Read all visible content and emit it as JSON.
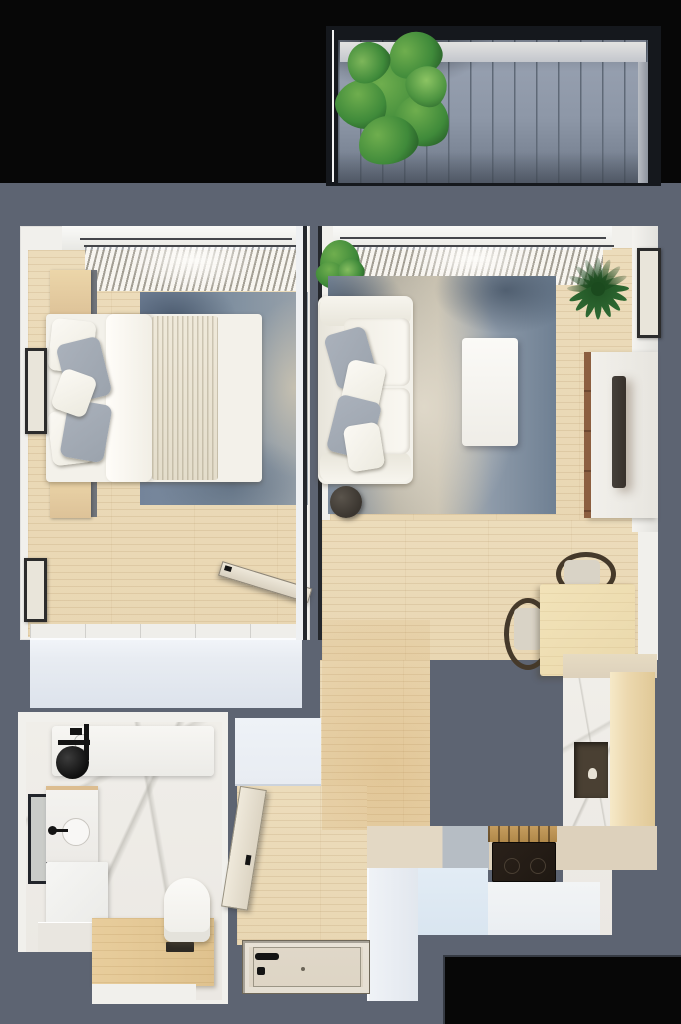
{
  "meta": {
    "title": "One-bedroom apartment floor plan, top-down 3D render",
    "image_type": "floor-plan",
    "view": "top-down"
  },
  "palette": {
    "outside": "#070707",
    "wall": "#5d6472",
    "room_wall_face": "#f1f0ec",
    "wood_floor": "#e9d7b3",
    "deck": "#8d97a7",
    "deck_line": "#5f6977",
    "rug_blue": "#8090a0",
    "rug_beige": "#c8c1b0",
    "fabric_white": "#f3f1ea",
    "pillow_gray": "#9ba3ad",
    "wardrobe": "#e8ecf2",
    "marble": "#ebe8e3",
    "platform_wood": "#dfc28e",
    "counter_beige": "#ddd1bc",
    "cabinet_blue": "#d9e5f0",
    "cabinet_white": "#eaeef2",
    "stove": "#1f1812",
    "brass": "#b08849",
    "niche": "#4a4033",
    "tall_wood": "#ecd8ae",
    "table_wood": "#ead8ab",
    "chair_frame": "#45392a",
    "tv_edge": "#8c5f40",
    "tv_screen": "#37302a",
    "door": "#ddd4c4",
    "fixture_black": "#141414",
    "plant_green": "#3f8a3a",
    "plant_dark": "#1d4d20"
  },
  "rooms": [
    {
      "id": "balcony",
      "label": "Balcony",
      "items": [
        "wood-decking",
        "potted-plant"
      ]
    },
    {
      "id": "bedroom",
      "label": "Bedroom",
      "items": [
        "window-curtains",
        "double-bed",
        "nightstand-left",
        "nightstand-right",
        "area-rug",
        "wardrobe",
        "wall-art-upper",
        "wall-art-lower",
        "open-door"
      ]
    },
    {
      "id": "living-room",
      "label": "Living room",
      "items": [
        "window-curtains",
        "sofa",
        "throw-pillows",
        "coffee-table",
        "side-table",
        "area-rug",
        "tv-stand",
        "tv",
        "wall-art",
        "corner-plant",
        "palm-plant"
      ]
    },
    {
      "id": "dining-nook",
      "label": "Dining nook",
      "items": [
        "dining-table",
        "chair-top",
        "chair-left"
      ]
    },
    {
      "id": "kitchen",
      "label": "Kitchen",
      "items": [
        "l-shaped-counter",
        "cooktop",
        "brass-hood-vent",
        "tall-marble-cabinet",
        "open-niche",
        "tall-wood-cabinet"
      ]
    },
    {
      "id": "bathroom",
      "label": "Bathroom",
      "items": [
        "shower-set",
        "bath-shelf",
        "mirror",
        "vanity-sink",
        "washing-machine",
        "toilet",
        "wood-platform"
      ]
    },
    {
      "id": "hallway",
      "label": "Entry hall",
      "items": [
        "entry-door",
        "hall-cabinet",
        "bathroom-door"
      ]
    }
  ]
}
